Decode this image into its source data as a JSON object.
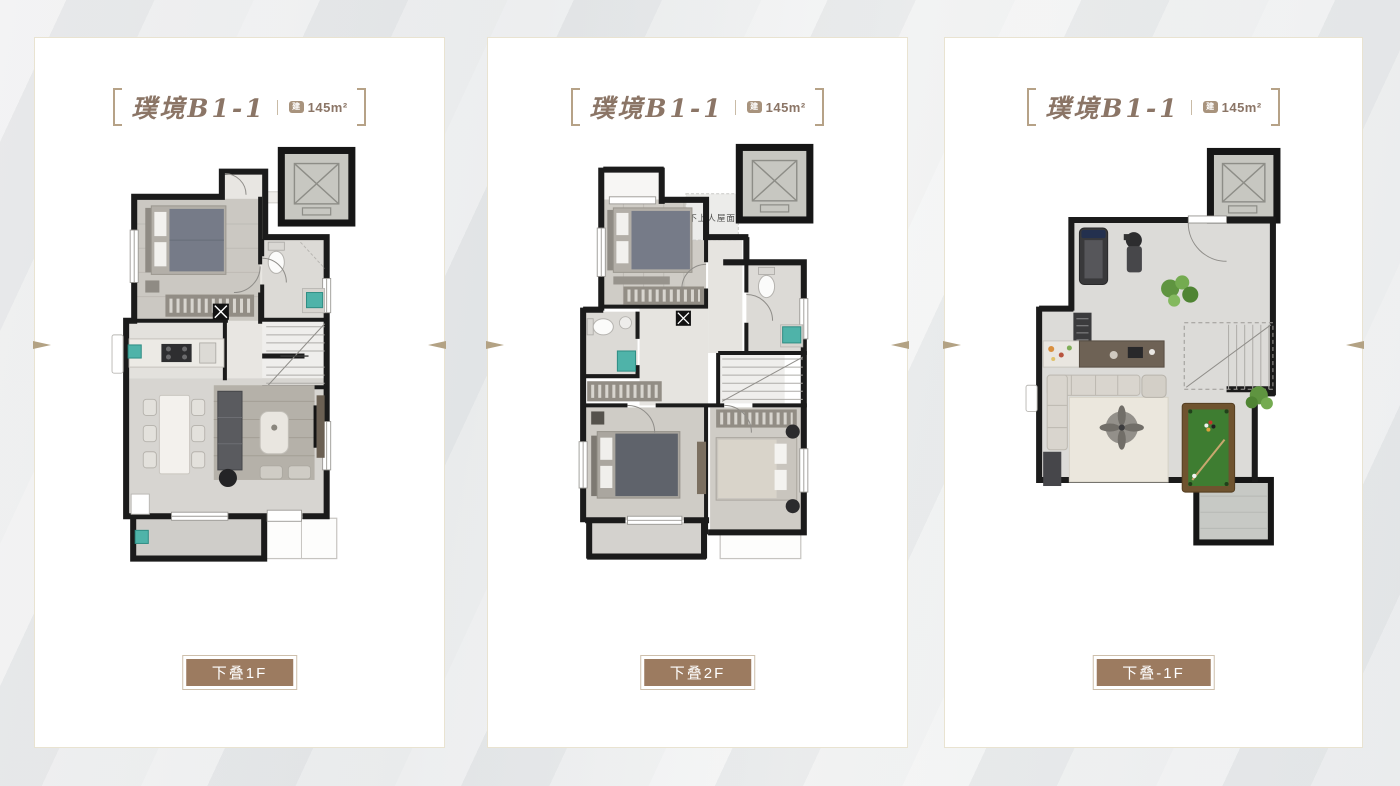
{
  "page": {
    "background": "#e7e8e9"
  },
  "cards": [
    {
      "title": "璞境B1-1",
      "area_icon": "建",
      "area": "145m²",
      "floor_label": "下叠1F"
    },
    {
      "title": "璞境B1-1",
      "area_icon": "建",
      "area": "145m²",
      "floor_label": "下叠2F",
      "roof_note": "不上人屋面"
    },
    {
      "title": "璞境B1-1",
      "area_icon": "建",
      "area": "145m²",
      "floor_label": "下叠-1F"
    }
  ],
  "colors": {
    "title_text": "#8b7566",
    "bracket": "#b6a287",
    "floor_label_bg": "#9c7b60",
    "floor_label_text": "#ffffff",
    "card_border": "#e9e3d1",
    "wall_black": "#1b1b1b",
    "billiard_green": "#3e7d31",
    "plant_green": "#6da348",
    "fixture_teal": "#4fb3a9"
  }
}
